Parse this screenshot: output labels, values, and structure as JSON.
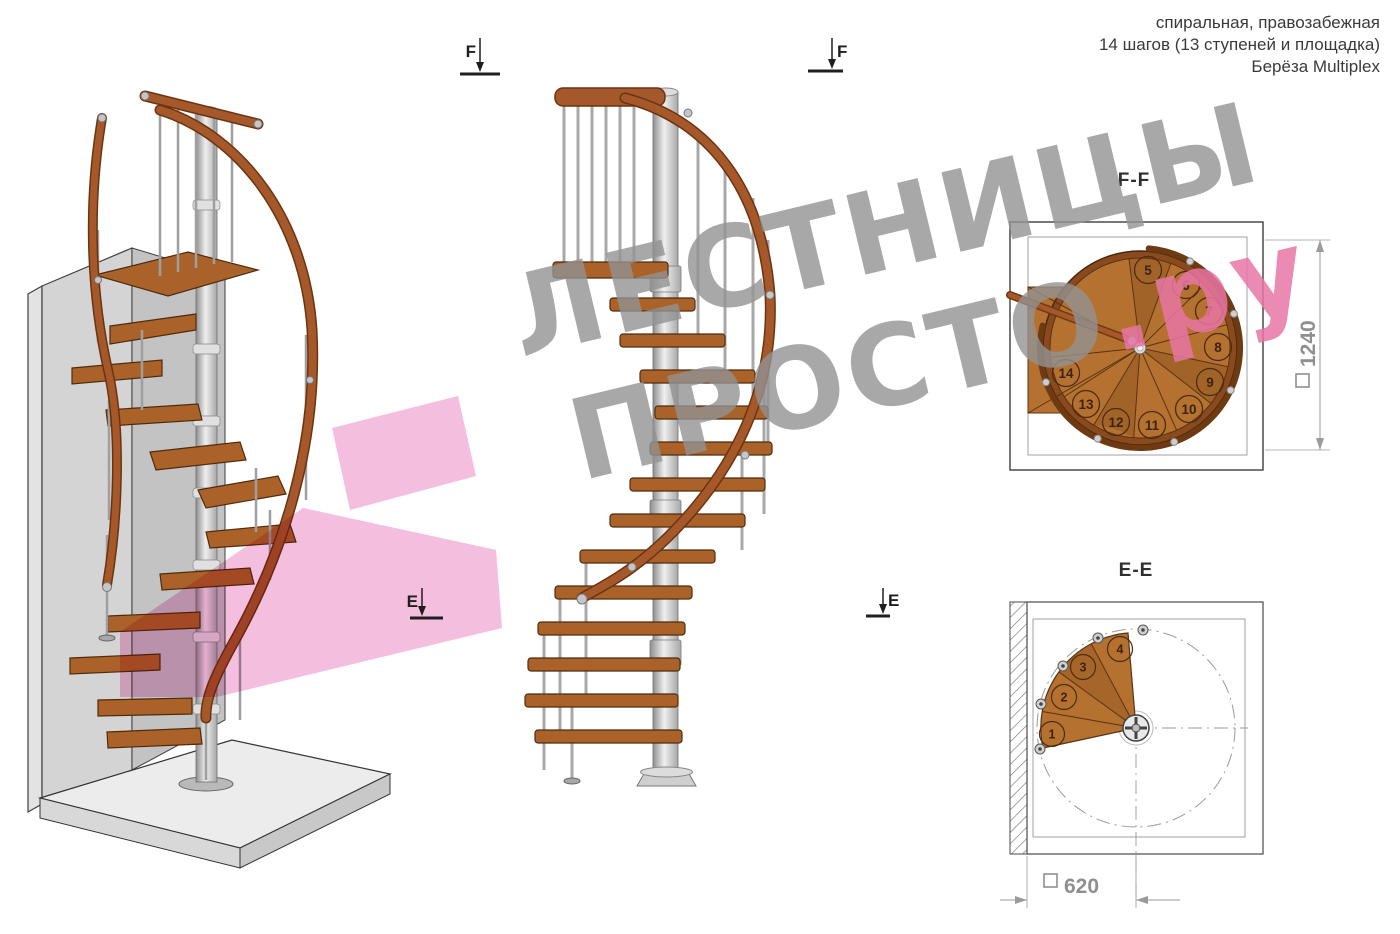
{
  "header": {
    "line1": "спиральная, правозабежная",
    "line2": "14 шагов (13 ступеней и площадка)",
    "line3": "Берёза Multiplex"
  },
  "watermark": {
    "line1": "ЛЕСТНИЦЫ",
    "line2_gray": "ПРОСТО",
    "line2_accent": ".ру",
    "gray_color": "#929292",
    "accent_color": "#e776a4",
    "arrow_color": "#f2aed6"
  },
  "markers": {
    "f": "F",
    "e": "E"
  },
  "ff_view": {
    "title": "F-F",
    "dimension_square": "□",
    "dimension_value": "1240",
    "step_numbers": [
      5,
      6,
      7,
      8,
      9,
      10,
      11,
      12,
      13,
      14
    ]
  },
  "ee_view": {
    "title": "E-E",
    "dimension_square": "□",
    "dimension_value": "620",
    "step_numbers": [
      1,
      2,
      3,
      4
    ]
  },
  "colors": {
    "wood": "#b5712f",
    "wood_dark": "#5a3315",
    "rail": "#a5582a",
    "metal": "#c9c9c9",
    "wall": "#d4d4d4",
    "dimension_gray": "#8f8f8f",
    "line_dark": "#2f2f2f"
  }
}
